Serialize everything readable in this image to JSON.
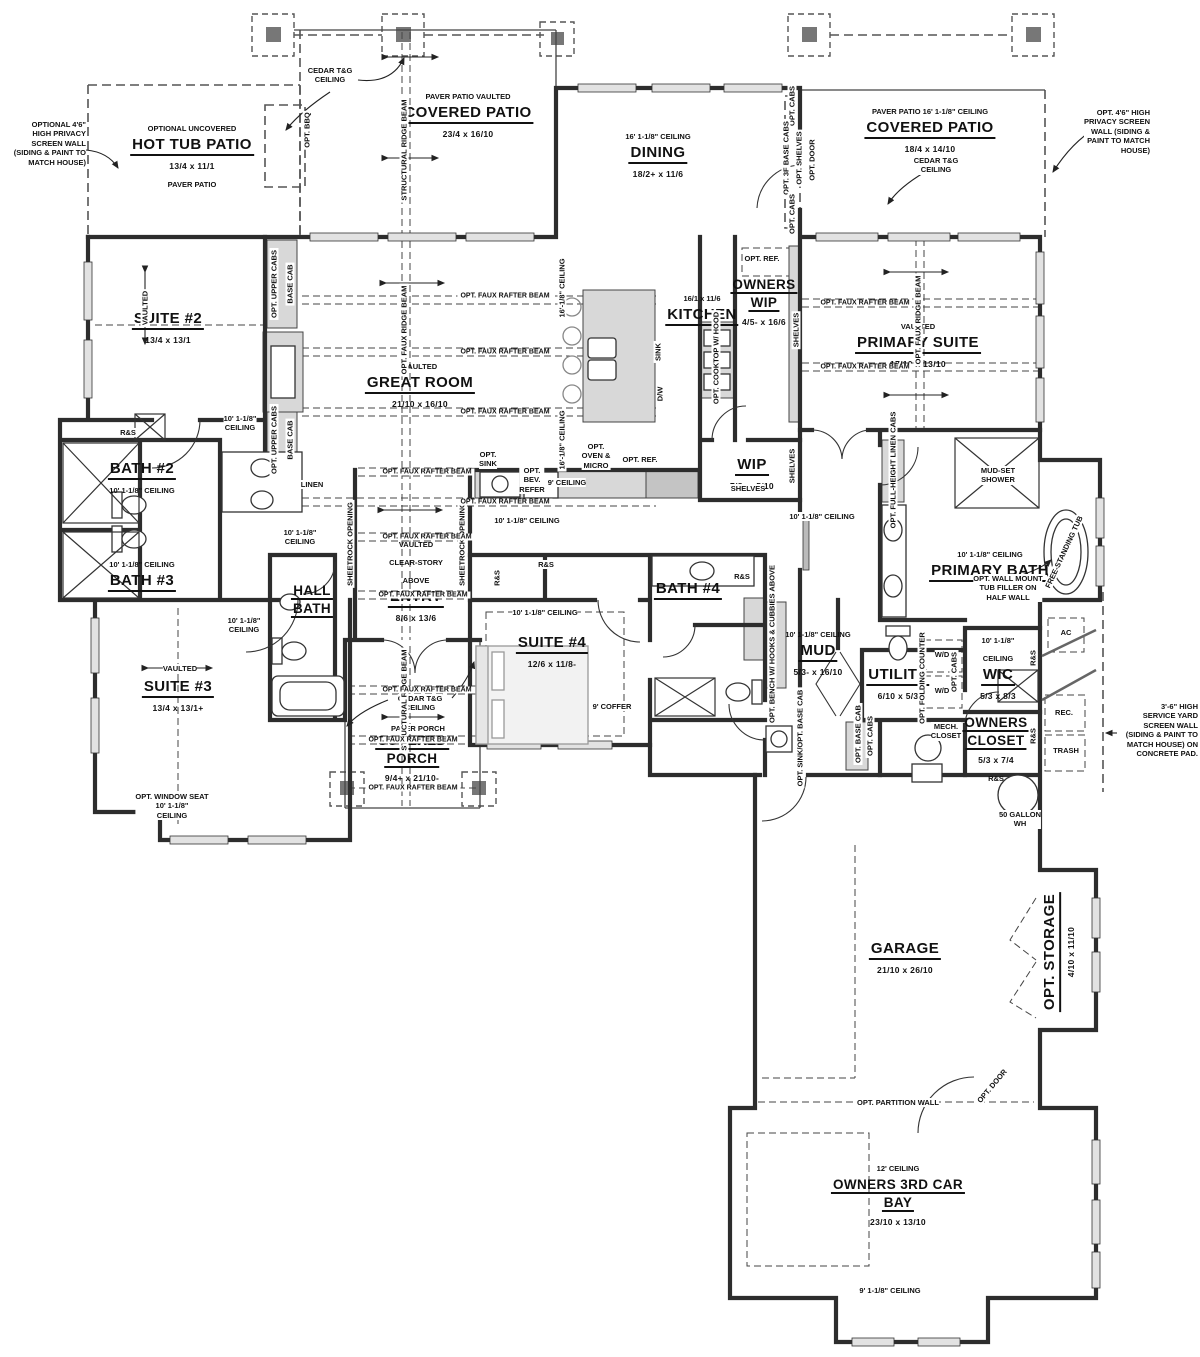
{
  "beam_label": "OPT. FAUX RAFTER BEAM",
  "labels": [
    {
      "id": "hot-tub-patio",
      "x": 192,
      "y": 118,
      "lines": [
        {
          "t": "OPTIONAL UNCOVERED",
          "c": "pre"
        },
        {
          "t": "HOT TUB PATIO",
          "c": "name"
        },
        {
          "t": "13/4 x 11/1",
          "c": "dims"
        },
        {
          "t": "PAVER PATIO",
          "c": "pre"
        }
      ]
    },
    {
      "id": "covered-patio-center",
      "x": 468,
      "y": 86,
      "lines": [
        {
          "t": "PAVER PATIO VAULTED",
          "c": "pre"
        },
        {
          "t": "COVERED PATIO",
          "c": "name"
        },
        {
          "t": "23/4 x 16/10",
          "c": "dims"
        }
      ]
    },
    {
      "id": "dining",
      "x": 658,
      "y": 126,
      "lines": [
        {
          "t": "16' 1-1/8\" CEILING",
          "c": "pre"
        },
        {
          "t": "DINING",
          "c": "name"
        },
        {
          "t": "18/2+ x 11/6",
          "c": "dims"
        }
      ]
    },
    {
      "id": "covered-patio-right",
      "x": 930,
      "y": 101,
      "lines": [
        {
          "t": "PAVER PATIO  16' 1-1/8\" CEILING",
          "c": "pre"
        },
        {
          "t": "COVERED PATIO",
          "c": "name"
        },
        {
          "t": "18/4 x 14/10",
          "c": "dims"
        }
      ]
    },
    {
      "id": "suite-2",
      "x": 168,
      "y": 310,
      "lines": [
        {
          "t": "SUITE #2",
          "c": "name"
        },
        {
          "t": "13/4 x 13/1",
          "c": "dims"
        }
      ]
    },
    {
      "id": "great-room",
      "x": 420,
      "y": 356,
      "lines": [
        {
          "t": "VAULTED",
          "c": "pre"
        },
        {
          "t": "GREAT ROOM",
          "c": "name"
        },
        {
          "t": "21/10 x 16/10",
          "c": "dims"
        }
      ]
    },
    {
      "id": "kitchen",
      "x": 702,
      "y": 288,
      "lines": [
        {
          "t": "16/1 x 11/6",
          "c": "pre"
        },
        {
          "t": "KITCHEN",
          "c": "name"
        }
      ]
    },
    {
      "id": "owners-wip",
      "x": 764,
      "y": 276,
      "lines": [
        {
          "t": "OWNERS",
          "c": "name2"
        },
        {
          "t": "WIP",
          "c": "name2"
        },
        {
          "t": "4/5- x 16/6",
          "c": "dims"
        }
      ]
    },
    {
      "id": "primary-suite",
      "x": 918,
      "y": 316,
      "lines": [
        {
          "t": "VAULTED",
          "c": "pre"
        },
        {
          "t": "PRIMARY SUITE",
          "c": "name"
        },
        {
          "t": "17/10 x 13/10",
          "c": "dims"
        }
      ]
    },
    {
      "id": "bath-2",
      "x": 142,
      "y": 460,
      "lines": [
        {
          "t": "BATH #2",
          "c": "name"
        },
        {
          "t": "10' 1-1/8\" CEILING",
          "c": "pre"
        }
      ]
    },
    {
      "id": "bath-3",
      "x": 142,
      "y": 554,
      "lines": [
        {
          "t": "10' 1-1/8\" CEILING",
          "c": "pre"
        },
        {
          "t": "BATH #3",
          "c": "name"
        }
      ]
    },
    {
      "id": "wip",
      "x": 752,
      "y": 456,
      "lines": [
        {
          "t": "WIP",
          "c": "name"
        },
        {
          "t": "7/8- x 5/10",
          "c": "dims"
        }
      ]
    },
    {
      "id": "entry",
      "x": 416,
      "y": 534,
      "lines": [
        {
          "t": "VAULTED",
          "c": "pre"
        },
        {
          "t": "CLEAR-STORY",
          "c": "pre"
        },
        {
          "t": "ABOVE",
          "c": "pre"
        },
        {
          "t": "ENTRY",
          "c": "name"
        },
        {
          "t": "8/6 x 13/6",
          "c": "dims"
        }
      ]
    },
    {
      "id": "suite-4",
      "x": 552,
      "y": 634,
      "lines": [
        {
          "t": "SUITE #4",
          "c": "name"
        },
        {
          "t": "12/6 x 11/8-",
          "c": "dims"
        }
      ]
    },
    {
      "id": "bath-4",
      "x": 688,
      "y": 580,
      "lines": [
        {
          "t": "BATH #4",
          "c": "name"
        }
      ]
    },
    {
      "id": "primary-bath",
      "x": 990,
      "y": 544,
      "lines": [
        {
          "t": "10' 1-1/8\" CEILING",
          "c": "pre"
        },
        {
          "t": "PRIMARY BATH",
          "c": "name"
        }
      ]
    },
    {
      "id": "mud",
      "x": 818,
      "y": 624,
      "lines": [
        {
          "t": "10' 1-1/8\" CEILING",
          "c": "pre"
        },
        {
          "t": "MUD",
          "c": "name"
        },
        {
          "t": "5/3- x 16/10",
          "c": "dims"
        }
      ]
    },
    {
      "id": "utility",
      "x": 898,
      "y": 666,
      "lines": [
        {
          "t": "UTILITY",
          "c": "name"
        },
        {
          "t": "6/10 x 5/3",
          "c": "dims"
        }
      ]
    },
    {
      "id": "wic",
      "x": 998,
      "y": 630,
      "lines": [
        {
          "t": "10' 1-1/8\"",
          "c": "pre"
        },
        {
          "t": "CEILING",
          "c": "pre"
        },
        {
          "t": "WIC",
          "c": "name"
        },
        {
          "t": "5/3 x 8/3",
          "c": "dims"
        }
      ]
    },
    {
      "id": "owners-closet",
      "x": 996,
      "y": 714,
      "lines": [
        {
          "t": "OWNERS",
          "c": "name2"
        },
        {
          "t": "CLOSET",
          "c": "name2"
        },
        {
          "t": "5/3 x 7/4",
          "c": "dims"
        },
        {
          "t": "R&S",
          "c": "pre"
        }
      ]
    },
    {
      "id": "suite-3",
      "x": 178,
      "y": 678,
      "lines": [
        {
          "t": "SUITE #3",
          "c": "name"
        },
        {
          "t": "13/4 x 13/1+",
          "c": "dims"
        }
      ]
    },
    {
      "id": "hall-bath",
      "x": 312,
      "y": 582,
      "lines": [
        {
          "t": "HALL",
          "c": "name2"
        },
        {
          "t": "BATH",
          "c": "name2"
        }
      ]
    },
    {
      "id": "covered-porch",
      "x": 412,
      "y": 732,
      "lines": [
        {
          "t": "COVERED",
          "c": "name2"
        },
        {
          "t": "PORCH",
          "c": "name2"
        },
        {
          "t": "9/4+ x 21/10-",
          "c": "dims"
        }
      ]
    },
    {
      "id": "garage",
      "x": 905,
      "y": 940,
      "lines": [
        {
          "t": "GARAGE",
          "c": "name"
        },
        {
          "t": "21/10 x 26/10",
          "c": "dims"
        }
      ]
    },
    {
      "id": "owners-3rd-car-bay",
      "x": 898,
      "y": 1158,
      "lines": [
        {
          "t": "12' CEILING",
          "c": "pre"
        },
        {
          "t": "OWNERS 3RD CAR",
          "c": "name2"
        },
        {
          "t": "BAY",
          "c": "name2"
        },
        {
          "t": "23/10 x 13/10",
          "c": "dims"
        }
      ]
    },
    {
      "id": "opt-storage",
      "x": 1060,
      "y": 952,
      "rot": -90,
      "lines": [
        {
          "t": "OPT. STORAGE",
          "c": "name"
        },
        {
          "t": "4/10 x 11/10",
          "c": "dims"
        }
      ]
    }
  ],
  "notes": [
    {
      "id": "privacy-note-left",
      "x": 86,
      "y": 120,
      "align": "r",
      "lines": [
        "OPTIONAL 4'6\"",
        "HIGH PRIVACY",
        "SCREEN WALL",
        "(SIDING & PAINT TO",
        "MATCH HOUSE)"
      ]
    },
    {
      "id": "privacy-note-right",
      "x": 1150,
      "y": 108,
      "align": "r",
      "lines": [
        "OPT. 4'6\" HIGH",
        "PRIVACY SCREEN",
        "WALL (SIDING &",
        "PAINT TO MATCH",
        "HOUSE)"
      ]
    },
    {
      "id": "service-yard-note",
      "x": 1198,
      "y": 702,
      "align": "r",
      "lines": [
        "3'-6\" HIGH",
        "SERVICE YARD",
        "SCREEN WALL",
        "(SIDING & PAINT TO",
        "MATCH HOUSE) ON",
        "CONCRETE PAD."
      ]
    },
    {
      "id": "cedar-center",
      "x": 330,
      "y": 66,
      "lines": [
        "CEDAR T&G",
        "CEILING"
      ]
    },
    {
      "id": "cedar-right",
      "x": 936,
      "y": 156,
      "lines": [
        "CEDAR T&G",
        "CEILING"
      ]
    },
    {
      "id": "cedar-porch",
      "x": 420,
      "y": 694,
      "lines": [
        "CEDAR T&G",
        "CEILING"
      ]
    },
    {
      "id": "paver-porch",
      "x": 418,
      "y": 724,
      "lines": [
        "PAVER PORCH"
      ]
    },
    {
      "id": "opt-sink",
      "x": 488,
      "y": 450,
      "lines": [
        "OPT.",
        "SINK"
      ]
    },
    {
      "id": "opt-bev-refer",
      "x": 532,
      "y": 466,
      "lines": [
        "OPT.",
        "BEV.",
        "REFER"
      ]
    },
    {
      "id": "nine-ceiling",
      "x": 567,
      "y": 478,
      "lines": [
        "9' CEILING"
      ]
    },
    {
      "id": "opt-oven-micro",
      "x": 596,
      "y": 442,
      "lines": [
        "OPT.",
        "OVEN &",
        "MICRO"
      ]
    },
    {
      "id": "opt-ref-kitchen",
      "x": 640,
      "y": 455,
      "lines": [
        "OPT. REF."
      ]
    },
    {
      "id": "opt-ref-wip",
      "x": 762,
      "y": 254,
      "lines": [
        "OPT. REF."
      ]
    },
    {
      "id": "shelves-wip",
      "x": 748,
      "y": 484,
      "lines": [
        "SHELVES"
      ]
    },
    {
      "id": "mud-set-shower",
      "x": 998,
      "y": 466,
      "lines": [
        "MUD-SET",
        "SHOWER"
      ]
    },
    {
      "id": "tub-filler-note",
      "x": 1008,
      "y": 574,
      "lines": [
        "OPT. WALL MOUNT",
        "TUB FILLER ON",
        "HALF WALL"
      ]
    },
    {
      "id": "mech-closet",
      "x": 946,
      "y": 722,
      "lines": [
        "MECH.",
        "CLOSET"
      ]
    },
    {
      "id": "wh-50",
      "x": 1020,
      "y": 810,
      "lines": [
        "50 GALLON",
        "WH"
      ]
    },
    {
      "id": "ac",
      "x": 1066,
      "y": 628,
      "lines": [
        "AC"
      ]
    },
    {
      "id": "rec",
      "x": 1064,
      "y": 708,
      "lines": [
        "REC."
      ]
    },
    {
      "id": "trash",
      "x": 1066,
      "y": 746,
      "lines": [
        "TRASH"
      ]
    },
    {
      "id": "wd-1",
      "x": 942,
      "y": 650,
      "lines": [
        "W/D"
      ]
    },
    {
      "id": "wd-2",
      "x": 942,
      "y": 686,
      "lines": [
        "W/D"
      ]
    },
    {
      "id": "coffer",
      "x": 612,
      "y": 702,
      "lines": [
        "9' COFFER"
      ]
    },
    {
      "id": "linen",
      "x": 312,
      "y": 480,
      "lines": [
        "LINEN"
      ]
    },
    {
      "id": "window-seat",
      "x": 172,
      "y": 792,
      "lines": [
        "OPT. WINDOW SEAT",
        "10' 1-1/8\"",
        "CEILING"
      ]
    },
    {
      "id": "ceiling-hall-1",
      "x": 300,
      "y": 528,
      "lines": [
        "10' 1-1/8\"",
        "CEILING"
      ]
    },
    {
      "id": "ceiling-hall-2",
      "x": 244,
      "y": 616,
      "lines": [
        "10' 1-1/8\"",
        "CEILING"
      ]
    },
    {
      "id": "ceiling-kitchen-hall",
      "x": 527,
      "y": 516,
      "lines": [
        "10' 1-1/8\" CEILING"
      ]
    },
    {
      "id": "ceiling-suite4",
      "x": 545,
      "y": 608,
      "lines": [
        "10' 1-1/8\" CEILING"
      ]
    },
    {
      "id": "ceiling-primary-hall",
      "x": 822,
      "y": 512,
      "lines": [
        "10' 1-1/8\" CEILING"
      ]
    },
    {
      "id": "ceiling-suite2-hall",
      "x": 240,
      "y": 414,
      "lines": [
        "10' 1-1/8\"",
        "CEILING"
      ]
    },
    {
      "id": "vaulted-suite3",
      "x": 180,
      "y": 664,
      "lines": [
        "VAULTED"
      ]
    },
    {
      "id": "opt-partition",
      "x": 898,
      "y": 1098,
      "lines": [
        "OPT. PARTITION WALL"
      ]
    },
    {
      "id": "ceiling-9-bay",
      "x": 890,
      "y": 1286,
      "lines": [
        "9' 1-1/8\" CEILING"
      ]
    },
    {
      "id": "rs-suite2",
      "x": 128,
      "y": 428,
      "lines": [
        "R&S"
      ]
    },
    {
      "id": "rs-closet-1",
      "x": 546,
      "y": 560,
      "lines": [
        "R&S"
      ]
    },
    {
      "id": "rs-closet-2",
      "x": 742,
      "y": 572,
      "lines": [
        "R&S"
      ]
    }
  ],
  "vtexts": [
    {
      "id": "structural-ridge-beam",
      "x": 404,
      "y": 150,
      "text": "STRUCTURAL RIDGE BEAM"
    },
    {
      "id": "opt-faux-ridge-beam",
      "x": 404,
      "y": 330,
      "text": "OPT. FAUX RIDGE BEAM"
    },
    {
      "id": "opt-faux-ridge-beam-primary",
      "x": 918,
      "y": 320,
      "text": "OPT. FAUX RIDGE BEAM"
    },
    {
      "id": "structural-ridge-beam-porch",
      "x": 404,
      "y": 700,
      "text": "STRUCTURAL RIDGE BEAM"
    },
    {
      "id": "ceiling-16-v1",
      "x": 562,
      "y": 288,
      "text": "16'-1/8\" CEILING"
    },
    {
      "id": "ceiling-16-v2",
      "x": 562,
      "y": 440,
      "text": "16'-1/8\" CEILING"
    },
    {
      "id": "opt-upper-cabs-1",
      "x": 274,
      "y": 284,
      "text": "OPT. UPPER CABS"
    },
    {
      "id": "base-cab-1",
      "x": 290,
      "y": 284,
      "text": "BASE CAB"
    },
    {
      "id": "opt-upper-cabs-2",
      "x": 274,
      "y": 440,
      "text": "OPT. UPPER CABS"
    },
    {
      "id": "base-cab-2",
      "x": 290,
      "y": 440,
      "text": "BASE CAB"
    },
    {
      "id": "opt-cabs-dining-top",
      "x": 792,
      "y": 106,
      "text": "OPT. CABS"
    },
    {
      "id": "opt-3f-base-cabs",
      "x": 786,
      "y": 158,
      "text": "OPT. 3F BASE CABS"
    },
    {
      "id": "opt-shelves-dining",
      "x": 799,
      "y": 158,
      "text": "OPT. SHELVES"
    },
    {
      "id": "opt-door-dining",
      "x": 812,
      "y": 160,
      "text": "OPT. DOOR"
    },
    {
      "id": "opt-cabs-dining-bot",
      "x": 792,
      "y": 214,
      "text": "OPT. CABS"
    },
    {
      "id": "opt-bbq",
      "x": 307,
      "y": 130,
      "text": "OPT. BBQ"
    },
    {
      "id": "vaulted-suite2",
      "x": 145,
      "y": 308,
      "text": "VAULTED"
    },
    {
      "id": "sink-island",
      "x": 658,
      "y": 352,
      "text": "SINK"
    },
    {
      "id": "dw",
      "x": 660,
      "y": 394,
      "text": "D/W"
    },
    {
      "id": "opt-cooktop",
      "x": 716,
      "y": 358,
      "text": "OPT. COOKTOP W/ HOOD"
    },
    {
      "id": "shelves-owners-wip",
      "x": 796,
      "y": 330,
      "text": "SHELVES"
    },
    {
      "id": "shelves-wip-v",
      "x": 792,
      "y": 466,
      "text": "SHELVES"
    },
    {
      "id": "opt-linen-cabs",
      "x": 893,
      "y": 470,
      "text": "OPT. FULL-HEIGHT LINEN CABS"
    },
    {
      "id": "free-standing-tub",
      "x": 1064,
      "y": 552,
      "rot": -65,
      "text": "FREE-STANDING TUB"
    },
    {
      "id": "opt-bench",
      "x": 772,
      "y": 644,
      "text": "OPT. BENCH W/ HOOKS & CUBBIES ABOVE"
    },
    {
      "id": "opt-folding-counter",
      "x": 922,
      "y": 678,
      "text": "OPT. FOLDING COUNTER"
    },
    {
      "id": "opt-cabs-utility",
      "x": 954,
      "y": 672,
      "text": "OPT. CABS"
    },
    {
      "id": "opt-sink-base-cab",
      "x": 800,
      "y": 738,
      "text": "OPT. SINK/OPT. BASE CAB"
    },
    {
      "id": "opt-base-cab-hall",
      "x": 858,
      "y": 734,
      "text": "OPT. BASE CAB"
    },
    {
      "id": "opt-cabs-hall",
      "x": 870,
      "y": 736,
      "text": "OPT. CABS"
    },
    {
      "id": "sheetrock-opening-l",
      "x": 350,
      "y": 544,
      "text": "SHEETROCK OPENING"
    },
    {
      "id": "sheetrock-opening-r",
      "x": 462,
      "y": 544,
      "text": "SHEETROCK OPENING"
    },
    {
      "id": "rs-entry-closet",
      "x": 497,
      "y": 578,
      "text": "R&S"
    },
    {
      "id": "rs-wic",
      "x": 1033,
      "y": 658,
      "text": "R&S"
    },
    {
      "id": "rs-owners-closet",
      "x": 1033,
      "y": 736,
      "text": "R&S"
    },
    {
      "id": "opt-door-diag",
      "x": 992,
      "y": 1086,
      "rot": -50,
      "text": "OPT. DOOR"
    }
  ],
  "beams": [
    {
      "x": 505,
      "y": 296
    },
    {
      "x": 505,
      "y": 352
    },
    {
      "x": 505,
      "y": 412
    },
    {
      "x": 505,
      "y": 502
    },
    {
      "x": 427,
      "y": 472
    },
    {
      "x": 427,
      "y": 537
    },
    {
      "x": 423,
      "y": 595
    },
    {
      "x": 427,
      "y": 690
    },
    {
      "x": 413,
      "y": 740
    },
    {
      "x": 413,
      "y": 788
    },
    {
      "x": 865,
      "y": 303
    },
    {
      "x": 865,
      "y": 367
    }
  ]
}
